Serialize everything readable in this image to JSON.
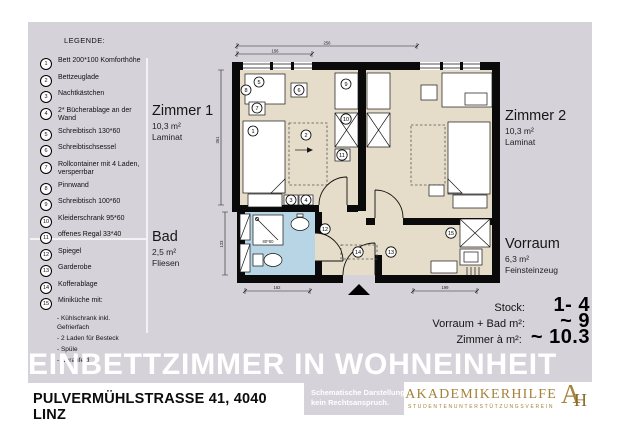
{
  "legend": {
    "title": "LEGENDE:",
    "items": [
      {
        "num": "1",
        "label": "Bett 200*100 Komforthöhe"
      },
      {
        "num": "2",
        "label": "Bettzeuglade"
      },
      {
        "num": "3",
        "label": "Nachtkästchen"
      },
      {
        "num": "4",
        "label": "2* Bücherablage an der Wand"
      },
      {
        "num": "5",
        "label": "Schreibtisch 130*60"
      },
      {
        "num": "6",
        "label": "Schreibtischsessel"
      },
      {
        "num": "7",
        "label": "Rollcontainer mit 4 Laden, versperrbar"
      },
      {
        "num": "8",
        "label": "Pinnwand"
      },
      {
        "num": "9",
        "label": "Schreibtisch 100*60"
      },
      {
        "num": "10",
        "label": "Kleiderschrank 95*60"
      },
      {
        "num": "11",
        "label": "offenes Regal 33*40"
      },
      {
        "num": "12",
        "label": "Spiegel"
      },
      {
        "num": "13",
        "label": "Garderobe"
      },
      {
        "num": "14",
        "label": "Kofferablage"
      },
      {
        "num": "15",
        "label": "Miniküche mit:"
      }
    ],
    "minikueche_details": [
      "- Kühlschrank inkl. Gefrierfach",
      "- 2 Laden für Besteck",
      "- Spüle",
      "- Ceranfeld"
    ]
  },
  "plan": {
    "room1": {
      "name": "Zimmer 1",
      "area": "10,3 m²",
      "floor": "Laminat"
    },
    "room2": {
      "name": "Zimmer 2",
      "area": "10,3 m²",
      "floor": "Laminat"
    },
    "bad": {
      "name": "Bad",
      "area": "2,5 m²",
      "floor": "Fliesen"
    },
    "vorraum": {
      "name": "Vorraum",
      "area": "6,3 m²",
      "floor": "Feinsteinzeug"
    },
    "dims": {
      "top_outer": "256",
      "top_inner": "156",
      "room_height": "361",
      "bad_height": "123",
      "bottom_bad": "162",
      "bottom_vorraum": "199",
      "shower": "80*80"
    },
    "markers": [
      "1",
      "2",
      "3",
      "4",
      "5",
      "6",
      "7",
      "8",
      "9",
      "10",
      "11",
      "12",
      "13",
      "14",
      "15"
    ]
  },
  "stats": {
    "row1": {
      "label": "Stock:",
      "value": "1- 4"
    },
    "row2": {
      "label": "Vorraum + Bad m²:",
      "value": "~ 9"
    },
    "row3": {
      "label": "Zimmer à m²:",
      "value": "~ 10.3"
    }
  },
  "footer": {
    "title": "EINBETTZIMMER IN WOHNEINHEIT",
    "address": "PULVERMÜHLSTRASSE 41, 4040 LINZ",
    "disclaimer1": "Schematische Darstellung,",
    "disclaimer2": "kein Rechtsanspruch.",
    "logo_name": "AKADEMIKERHILFE",
    "logo_subtitle": "STUDENTENUNTERSTÜTZUNGSVEREIN",
    "logo_monogram_a": "A",
    "logo_monogram_h": "H"
  },
  "colors": {
    "panel": "#d6d2da",
    "floor": "#e5ddc9",
    "bath": "#b7d5e5",
    "gold": "#a5823a",
    "wall": "#0a0a0a"
  }
}
